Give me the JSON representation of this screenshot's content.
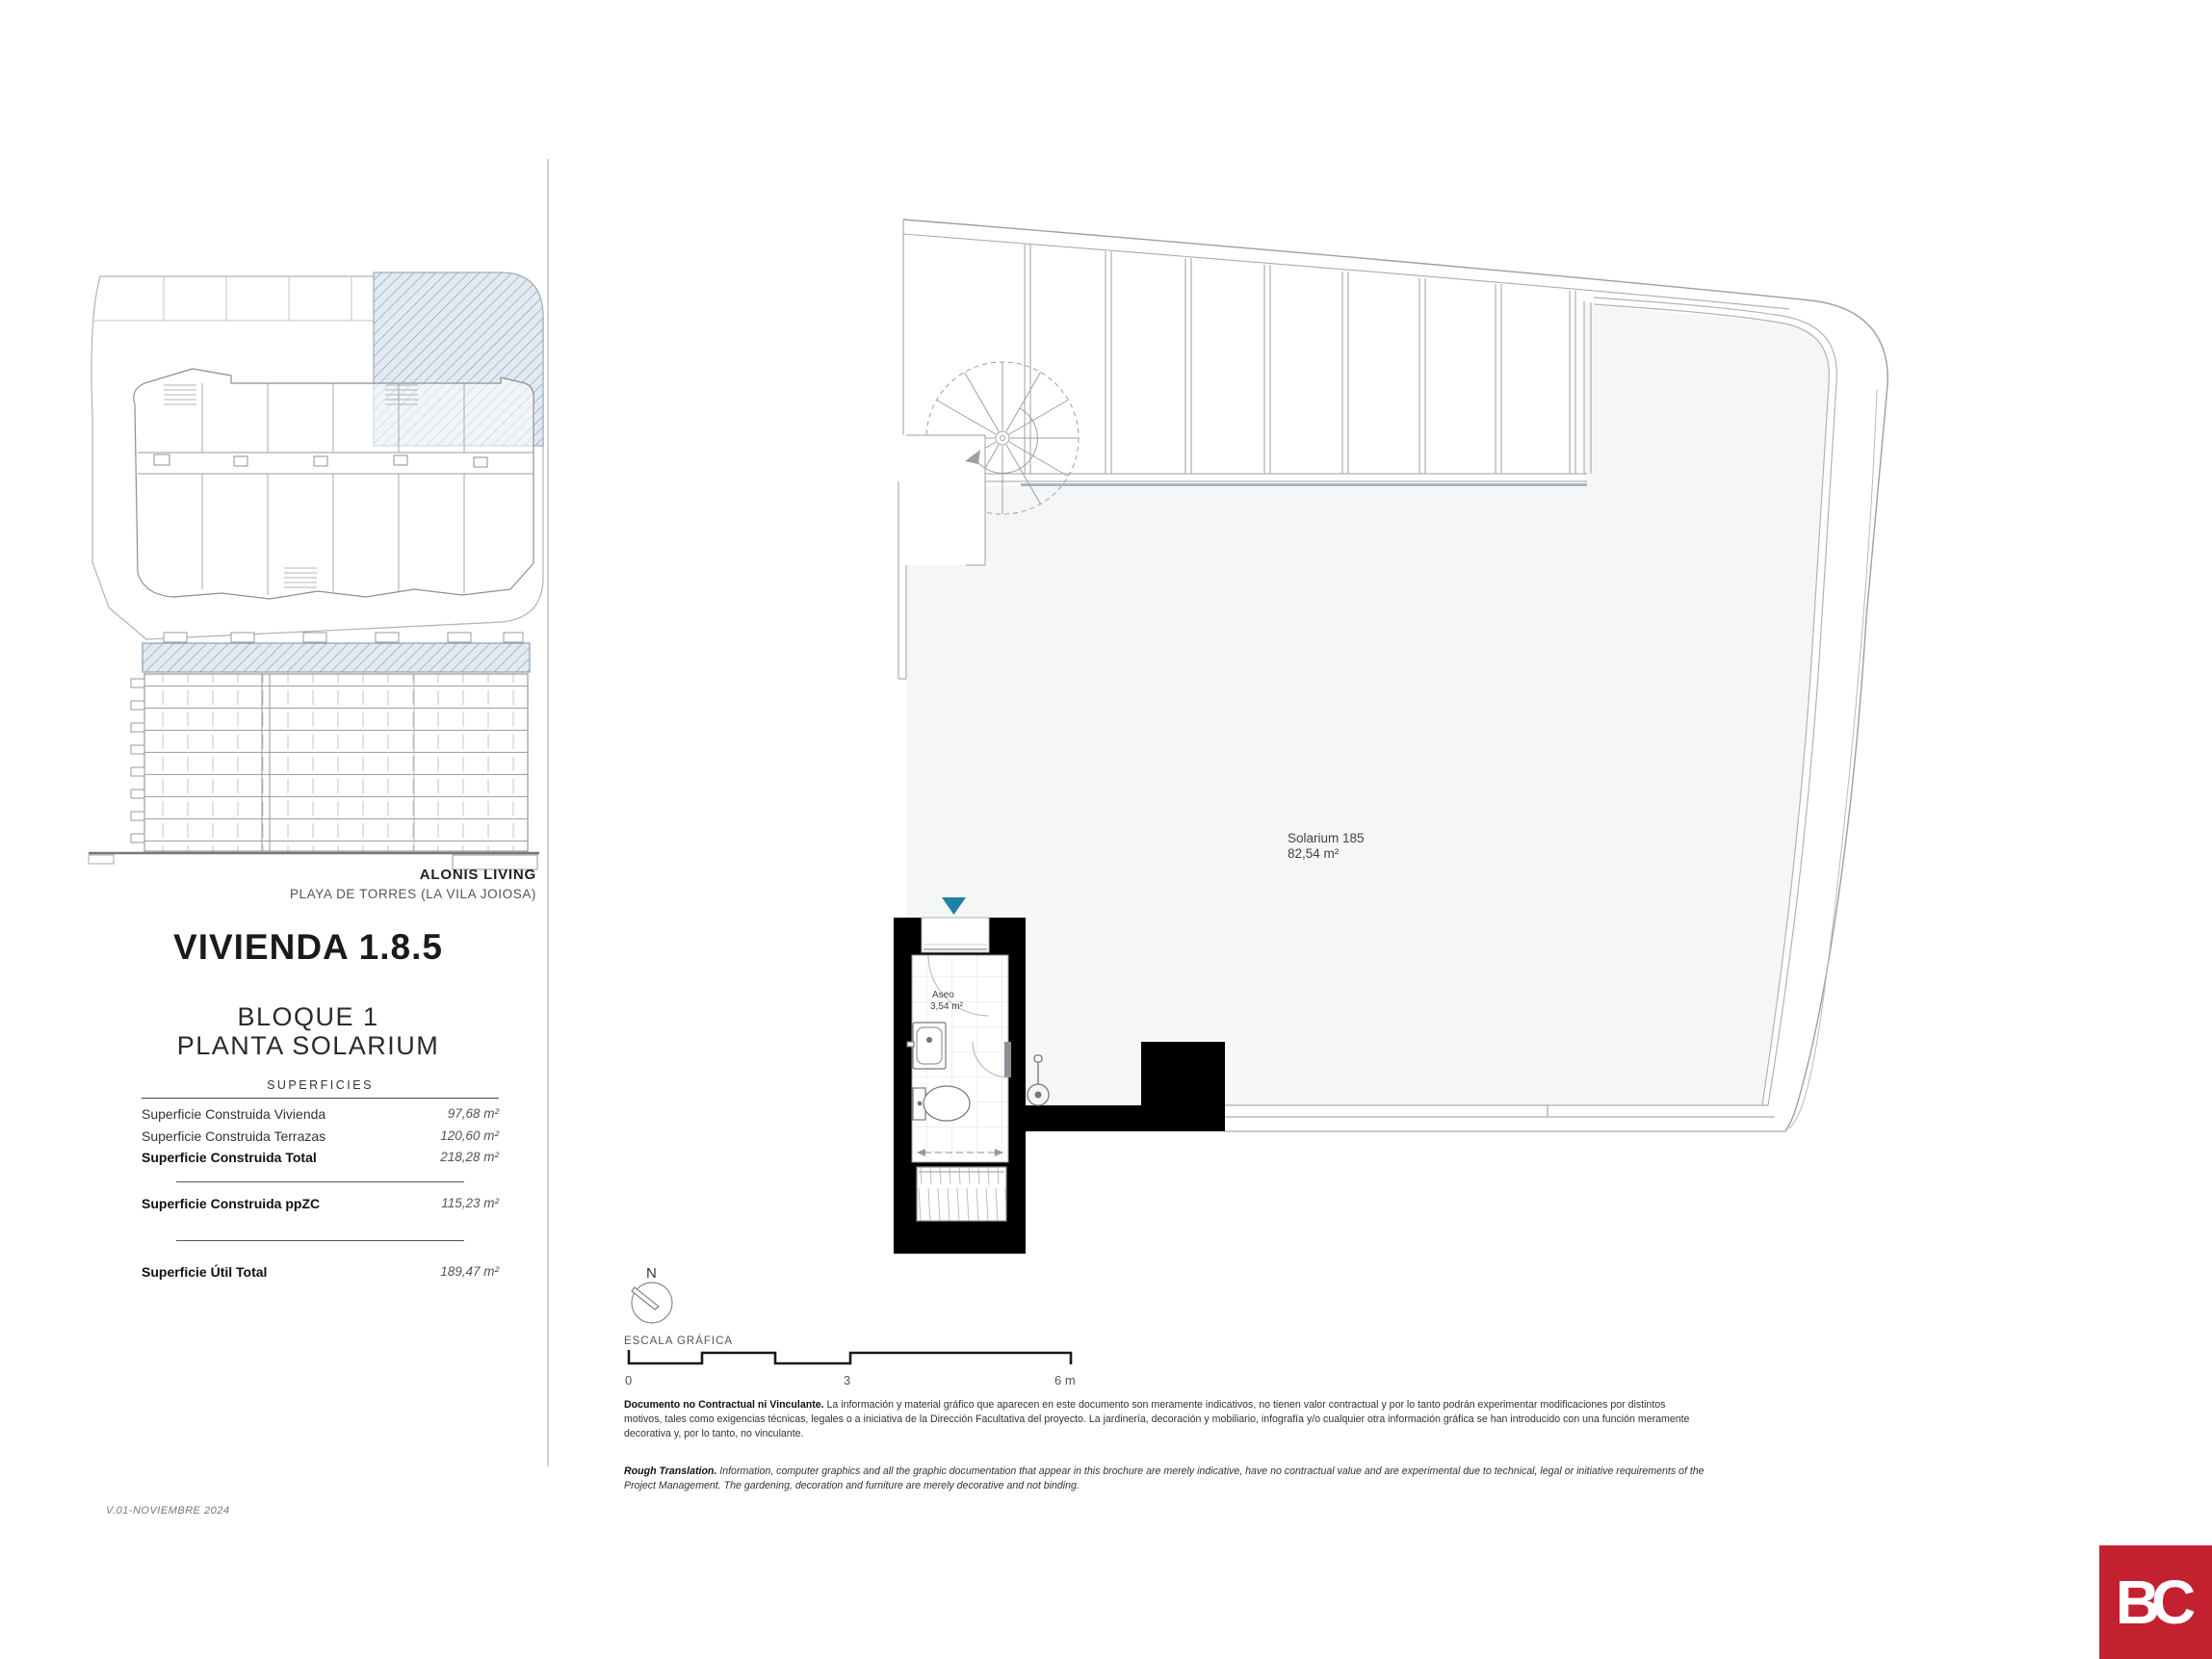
{
  "sidebar": {
    "project_name": "ALONIS LIVING",
    "project_location": "PLAYA DE TORRES (LA VILA JOIOSA)",
    "unit_title": "VIVIENDA 1.8.5",
    "block": "BLOQUE 1",
    "floor": "PLANTA SOLARIUM",
    "table": {
      "header": "SUPERFICIES",
      "rows": [
        {
          "label": "Superficie Construida Vivienda",
          "value": "97,68 m²"
        },
        {
          "label": "Superficie Construida Terrazas",
          "value": "120,60 m²"
        },
        {
          "label": "Superficie Construida Total",
          "value": "218,28 m²"
        },
        {
          "label": "Superficie Construida ppZC",
          "value": "115,23 m²"
        },
        {
          "label": "Superficie Útil Total",
          "value": "189,47 m²"
        }
      ]
    },
    "version": "V.01-NOVIEMBRE 2024"
  },
  "plan": {
    "room_label": "Solarium 185",
    "room_area": "82,54 m²",
    "bath_label": "Aseo",
    "bath_area": "3,54 m²"
  },
  "compass_label": "N",
  "scale_bar": {
    "title": "ESCALA GRÁFICA",
    "ticks": [
      "0",
      "3",
      "6 m"
    ]
  },
  "disclaimers": {
    "es_lead": "Documento no Contractual ni Vinculante.",
    "es_body": " La información y material gráfico que aparecen en este documento son meramente indicativos, no tienen valor contractual y por lo tanto podrán experimentar modificaciones por distintos motivos, tales como exigencias técnicas, legales o a iniciativa de la Dirección Facultativa del proyecto. La jardinería, decoración y mobiliario, infografía y/o cualquier otra información gráfica se han introducido con una función meramente decorativa y, por lo tanto, no vinculante.",
    "en_lead": "Rough Translation.",
    "en_body": " Information, computer graphics and all the graphic documentation that appear in this brochure are merely indicative, have no contractual value and are experimental due to technical, legal or initiative requirements of the Project Management. The gardening, decoration and furniture are merely decorative and not binding."
  },
  "logo_text": "BC",
  "colors": {
    "entry_marker_blue": "#1f80a8",
    "hatch_blue": "#7e95aa",
    "logo_red": "#c32030"
  }
}
